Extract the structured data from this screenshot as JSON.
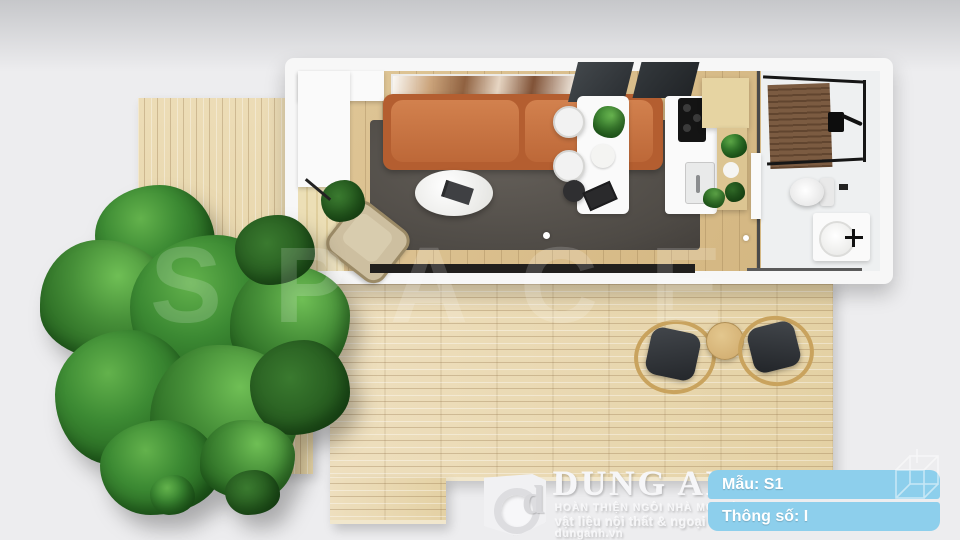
{
  "watermark": {
    "text": "SPACE"
  },
  "branding": {
    "monogram": "d",
    "company_name": "DUNG ANH",
    "tagline_primary": "HOÀN THIỆN NGÔI NHÀ MƠ ƯỚC",
    "tagline_secondary": "vật liệu nội thất & ngoại thất",
    "website": "dunganh.vn"
  },
  "info_badges": {
    "model_label": "Mẫu: S1",
    "spec_label": "Thông số: I",
    "background_color": "#8dcfec",
    "text_color": "#ffffff"
  },
  "scene": {
    "type": "top-view 3D render of container tiny house",
    "rooms": [
      "living-room",
      "dining-area",
      "kitchen",
      "bathroom"
    ],
    "objects": [
      "tree",
      "small-wood-platform",
      "large-wood-deck",
      "terracotta-sofa",
      "gray-rug",
      "oval-coffee-table",
      "armchair",
      "wall-art",
      "dining-table",
      "dining-chairs",
      "kitchen-counter",
      "cooktop",
      "kitchen-sink",
      "wood-shelf",
      "shower",
      "toilet",
      "vanity-sink",
      "outdoor-wicker-chairs",
      "outdoor-side-table",
      "potted-plants"
    ],
    "palette": {
      "background": "#ededef",
      "deck_wood": "#e9d9b2",
      "floor_wood": "#d8bd8a",
      "sofa_terracotta": "#c06a3a",
      "rug_gray": "#57534e",
      "tree_green": "#2e7d32",
      "shower_wood": "#6f523c",
      "badge_blue": "#8dcfec"
    }
  }
}
